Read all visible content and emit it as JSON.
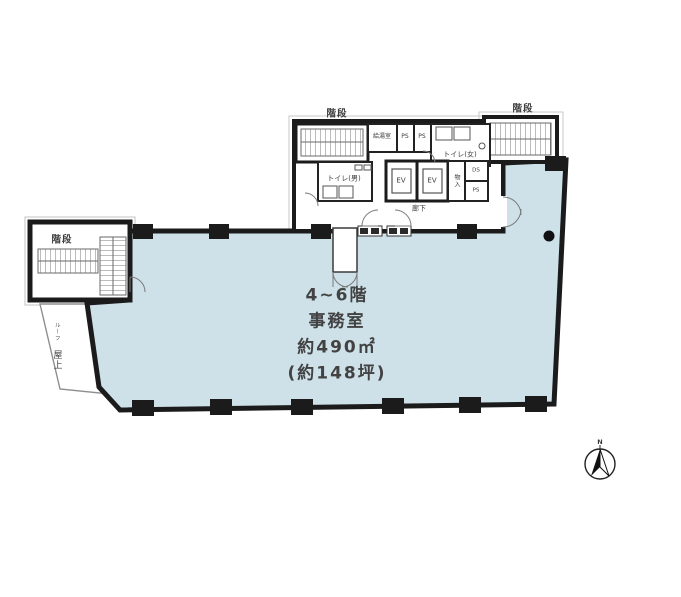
{
  "plan": {
    "type": "floor-plan",
    "office": {
      "lines": [
        "4~6階",
        "事務室",
        "約490㎡",
        "(約148坪)"
      ]
    },
    "labels": {
      "stair_top_left": "階段",
      "stair_top_right": "階段",
      "stair_left": "階段",
      "kitchenette": "給湯室",
      "ps_1": "PS",
      "ps_2": "PS",
      "toilet_women": "トイレ(女)",
      "toilet_men": "トイレ(男)",
      "ev_1": "EV",
      "ev_2": "EV",
      "storage": "物入",
      "duct": "DS",
      "ps_3": "PS",
      "corridor": "廊下",
      "roof_sub": "ルーフ",
      "roof": "屋上",
      "compass": "N"
    },
    "colors": {
      "office_fill": "#cee1e9",
      "wall": "#1b1b1b",
      "thin_line": "#777777",
      "text": "#3d3d3d"
    }
  }
}
